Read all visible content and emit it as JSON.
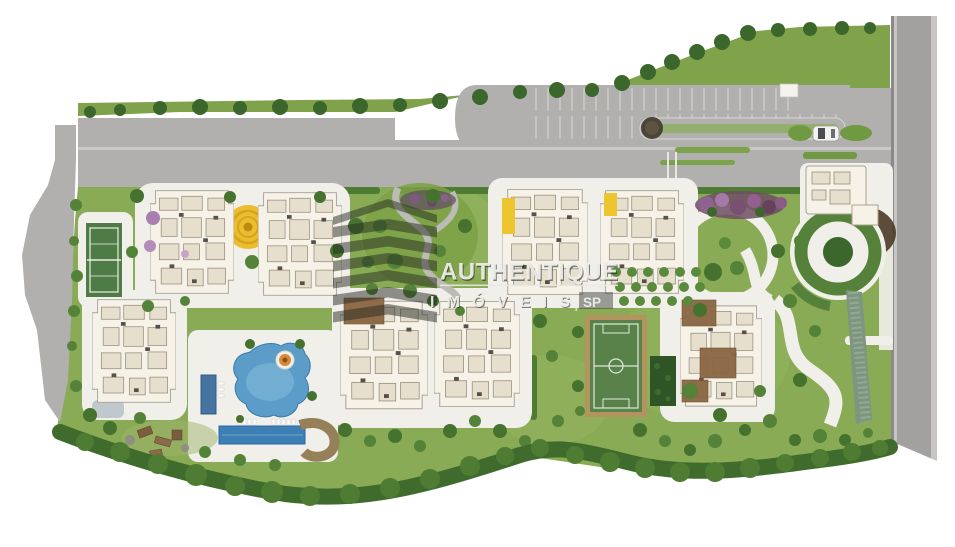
{
  "watermark": {
    "brand": "AUTHENTIQUE",
    "division": "IMÓVEIS",
    "separator": "|",
    "region": "SP"
  },
  "palette": {
    "background": "#ffffff",
    "road": "#b1b0ae",
    "road_inner": "#a2a1a0",
    "road_curb": "#c9c8c5",
    "lawn": "#8aab55",
    "lawn_dark": "#7ca145",
    "tree": "#45722e",
    "hedge": "#4e7c33",
    "plaza": "#f1efea",
    "building": "#f7f2e7",
    "court": "#4f7b47",
    "field": "#59824a",
    "field_border": "#b3945e",
    "pool": "#5b9dc8",
    "lap_pool": "#3d7fb5",
    "kids_pool": "#44749f",
    "sun_deck": "#e9bd2e",
    "spa": "#d9893a",
    "flower_tree": "#a87fae",
    "mulch": "#4a3b27",
    "watermark_text": "#ededea"
  },
  "features": [
    "main-access-road",
    "visitor-parking",
    "entrance-gatehouse",
    "perimeter-street",
    "tennis-court",
    "soccer-field",
    "leisure-pool",
    "lap-pool",
    "kids-pool",
    "spa-island",
    "sun-deck",
    "labyrinth-garden",
    "circular-lawn",
    "playground",
    "orchard-grid",
    "flower-beds",
    "water-feature",
    "apartment-towers",
    "tree-belt"
  ]
}
